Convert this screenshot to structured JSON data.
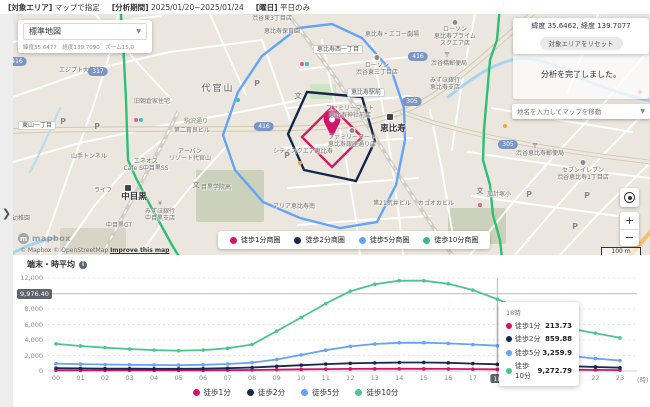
{
  "top_bar": {
    "filters": [
      {
        "label": "[対象エリア]",
        "value": "マップで指定"
      },
      {
        "label": "[分析期間]",
        "value": "2025/01/20~2025/01/24"
      },
      {
        "label": "[曜日]",
        "value": "平日のみ"
      }
    ]
  },
  "sidebar": {
    "expand_chevron": "❯"
  },
  "map": {
    "style_selector": {
      "value": "標準地図",
      "chevron": "▼",
      "meta": "緯度35.6477　経度139.7090　ズーム15.0"
    },
    "coords_panel": {
      "coords": "緯度 35.6462, 経度 139.7077",
      "reset_button": "対象エリアをリセット"
    },
    "toast": "分析を完了しました。",
    "search": {
      "placeholder": "地名を入力してマップを移動",
      "chevron": "▼"
    },
    "legend": [
      {
        "label": "徒歩1分商圏",
        "color": "#d4136b"
      },
      {
        "label": "徒歩2分商圏",
        "color": "#17294d"
      },
      {
        "label": "徒歩5分商圏",
        "color": "#64a3f5"
      },
      {
        "label": "徒歩10分商圏",
        "color": "#3dbd7d"
      }
    ],
    "controls": {
      "zoom_in": "+",
      "zoom_out": "−"
    },
    "scale_label": "100 m",
    "attribution": {
      "logo_text": "mapbox",
      "text": "© Mapbox © OpenStreetMap ",
      "improve_link": "Improve this map"
    },
    "labels": [
      {
        "t": "渋谷代官山郵便局",
        "x": 46,
        "y": 44,
        "c": "poi"
      },
      {
        "t": "エジプト大使館",
        "x": 80,
        "y": 67,
        "c": "poi"
      },
      {
        "t": "代官山",
        "x": 218,
        "y": 84,
        "c": "town"
      },
      {
        "t": "旧朝倉家住宅",
        "x": 152,
        "y": 98,
        "c": "poi"
      },
      {
        "t": "第二育良ビル",
        "x": 192,
        "y": 127,
        "c": "poi"
      },
      {
        "t": "山手トンネル",
        "x": 89,
        "y": 153,
        "c": "poi"
      },
      {
        "t": "アーバン\nリゾート代官山",
        "x": 190,
        "y": 148,
        "c": "poi"
      },
      {
        "t": "エネオス\nCafe S中目黒SS",
        "x": 146,
        "y": 158,
        "c": "poi"
      },
      {
        "t": "ライフ",
        "x": 103,
        "y": 187,
        "c": "poi"
      },
      {
        "t": "中目黒",
        "x": 134,
        "y": 192,
        "c": "station"
      },
      {
        "t": "中目黒GT",
        "x": 119,
        "y": 222,
        "c": "poi"
      },
      {
        "t": "みずほ銀行\n中目黒支店",
        "x": 160,
        "y": 208,
        "c": "poi"
      },
      {
        "t": "目黒学院高",
        "x": 216,
        "y": 184,
        "c": "poi"
      },
      {
        "t": "園幼稚園",
        "x": 18,
        "y": 215,
        "c": "poi"
      },
      {
        "t": "渋谷東3丁目店",
        "x": 272,
        "y": 15,
        "c": "poi"
      },
      {
        "t": "恵比寿保育園",
        "x": 282,
        "y": 28,
        "c": "poi"
      },
      {
        "t": "恵比寿・エコー劇場",
        "x": 392,
        "y": 31,
        "c": "poi"
      },
      {
        "t": "ローソン\n恵比寿プライム\nスクエア店",
        "x": 455,
        "y": 26,
        "c": "poi"
      },
      {
        "t": "ローソン\n渋谷東三丁目店",
        "x": 377,
        "y": 62,
        "c": "poi"
      },
      {
        "t": "ローソン",
        "x": 547,
        "y": 26,
        "c": "poi"
      },
      {
        "t": "渋谷橋郵便局",
        "x": 449,
        "y": 60,
        "c": "poi"
      },
      {
        "t": "みずほ銀行\n恵比寿支店",
        "x": 445,
        "y": 77,
        "c": "poi"
      },
      {
        "t": "ファミリーマート\n恵比寿神社前店",
        "x": 350,
        "y": 105,
        "c": "poi"
      },
      {
        "t": "ファミリーマート\n恵比寿銀座通り店",
        "x": 352,
        "y": 134,
        "c": "poi"
      },
      {
        "t": "恵比寿",
        "x": 393,
        "y": 124,
        "c": "station"
      },
      {
        "t": "シティスクエア恵比寿",
        "x": 303,
        "y": 148,
        "c": "poi"
      },
      {
        "t": "渋谷恵比寿郵便局",
        "x": 540,
        "y": 150,
        "c": "poi"
      },
      {
        "t": "セブンイレブン\n渋谷恵比寿1丁目店",
        "x": 583,
        "y": 167,
        "c": "poi"
      },
      {
        "t": "加計塚小",
        "x": 499,
        "y": 191,
        "c": "poi"
      },
      {
        "t": "カゴオカビル",
        "x": 436,
        "y": 200,
        "c": "poi"
      },
      {
        "t": "第21荒井ビル",
        "x": 392,
        "y": 200,
        "c": "poi"
      },
      {
        "t": "アリア恵比寿南",
        "x": 294,
        "y": 203,
        "c": "poi"
      },
      {
        "t": "駒沢通り",
        "x": 196,
        "y": 118,
        "c": "roadname"
      },
      {
        "t": "東山一丁目",
        "x": 37,
        "y": 121,
        "c": "pill"
      },
      {
        "t": "恵比寿西一丁目",
        "x": 338,
        "y": 45,
        "c": "pill"
      },
      {
        "t": "恵比寿駅前",
        "x": 366,
        "y": 88,
        "c": "pill"
      },
      {
        "t": "317",
        "x": 98,
        "y": 67,
        "c": "route"
      },
      {
        "t": "416",
        "x": 17,
        "y": 57,
        "c": "route"
      },
      {
        "t": "416",
        "x": 264,
        "y": 122,
        "c": "route"
      },
      {
        "t": "416",
        "x": 418,
        "y": 52,
        "c": "route"
      },
      {
        "t": "305",
        "x": 412,
        "y": 97,
        "c": "route"
      },
      {
        "t": "305",
        "x": 508,
        "y": 140,
        "c": "route"
      },
      {
        "t": "P",
        "x": 63,
        "y": 117,
        "c": "picon"
      },
      {
        "t": "P",
        "x": 97,
        "y": 122,
        "c": "picon"
      },
      {
        "t": "P",
        "x": 257,
        "y": 79,
        "c": "picon"
      },
      {
        "t": "P",
        "x": 287,
        "y": 151,
        "c": "picon"
      },
      {
        "t": "P",
        "x": 529,
        "y": 190,
        "c": "picon"
      },
      {
        "t": "P",
        "x": 587,
        "y": 191,
        "c": "picon"
      },
      {
        "t": "P",
        "x": 575,
        "y": 222,
        "c": "picon"
      },
      {
        "t": "文",
        "x": 298,
        "y": 92,
        "c": "school"
      },
      {
        "t": "文",
        "x": 196,
        "y": 181,
        "c": "school"
      },
      {
        "t": "文",
        "x": 480,
        "y": 187,
        "c": "school"
      },
      {
        "t": "文",
        "x": 10,
        "y": 208,
        "c": "school"
      },
      {
        "t": "〒",
        "x": 447,
        "y": 51,
        "c": "post"
      },
      {
        "t": "〒",
        "x": 535,
        "y": 142,
        "c": "post"
      },
      {
        "t": "〒",
        "x": 46,
        "y": 36,
        "c": "post"
      },
      {
        "t": "¥",
        "x": 160,
        "y": 200,
        "c": "yen"
      },
      {
        "t": "",
        "x": 390,
        "y": 113,
        "c": "sticon"
      },
      {
        "t": "",
        "x": 128,
        "y": 184,
        "c": "sticon"
      },
      {
        "t": "",
        "x": 377,
        "y": 54,
        "c": "cicon"
      },
      {
        "t": "",
        "x": 547,
        "y": 19,
        "c": "cicon"
      },
      {
        "t": "",
        "x": 583,
        "y": 159,
        "c": "cicon"
      },
      {
        "t": "",
        "x": 352,
        "y": 127,
        "c": "cicon"
      },
      {
        "t": "",
        "x": 455,
        "y": 19,
        "c": "cicon"
      }
    ],
    "dots": [
      {
        "x": 136,
        "y": 118,
        "color": "#e05c8a"
      },
      {
        "x": 141,
        "y": 118,
        "color": "#3bbccb"
      },
      {
        "x": 302,
        "y": 62,
        "color": "#e05c8a"
      },
      {
        "x": 307,
        "y": 62,
        "color": "#3bbccb"
      },
      {
        "x": 505,
        "y": 124,
        "color": "#f0a33c"
      },
      {
        "x": 576,
        "y": 108,
        "color": "#3bbccb"
      },
      {
        "x": 640,
        "y": 90,
        "color": "#e05c8a"
      },
      {
        "x": 480,
        "y": 203,
        "color": "#e05c8a"
      },
      {
        "x": 238,
        "y": 98,
        "color": "#3bbccb"
      },
      {
        "x": 300,
        "y": 161,
        "color": "#f0a33c"
      }
    ]
  },
  "chart": {
    "title": "端末・時平均",
    "info_icon": "i",
    "max_badge": "9,976.40",
    "unit_suffix": "(時)",
    "y_ticks": [
      {
        "v": 12000,
        "t": "12,000"
      },
      {
        "v": 8000,
        "t": "8,000"
      },
      {
        "v": 6000,
        "t": "6,000"
      },
      {
        "v": 4000,
        "t": "4,000"
      },
      {
        "v": 2000,
        "t": "2,000"
      },
      {
        "v": 0,
        "t": "0"
      }
    ],
    "selected_hour": "18",
    "tooltip": {
      "header": "18時",
      "rows": [
        {
          "label": "徒歩1分",
          "value": "213.73",
          "color": "#d4136b"
        },
        {
          "label": "徒歩2分",
          "value": "859.88",
          "color": "#17294d"
        },
        {
          "label": "徒歩5分",
          "value": "3,259.9",
          "color": "#64a3f5"
        },
        {
          "label": "徒歩10分",
          "value": "9,272.79",
          "color": "#4cc68e"
        }
      ]
    }
  },
  "chart_data": {
    "type": "line",
    "title": "端末・時平均",
    "x": [
      "00",
      "01",
      "02",
      "03",
      "04",
      "05",
      "06",
      "07",
      "08",
      "09",
      "10",
      "11",
      "12",
      "13",
      "14",
      "15",
      "16",
      "17",
      "18",
      "19",
      "20",
      "21",
      "22",
      "23"
    ],
    "xlabel": "(時)",
    "ylabel": "",
    "ylim": [
      0,
      12000
    ],
    "grid": true,
    "legend_position": "bottom",
    "reference_line": 9976.4,
    "selected_x": "18",
    "series": [
      {
        "name": "徒歩1分",
        "color": "#d4136b",
        "values": [
          95,
          88,
          84,
          80,
          78,
          78,
          85,
          105,
          135,
          175,
          215,
          245,
          265,
          278,
          283,
          280,
          268,
          240,
          213.73,
          195,
          178,
          162,
          140,
          118
        ]
      },
      {
        "name": "徒歩2分",
        "color": "#17294d",
        "values": [
          360,
          330,
          310,
          295,
          285,
          285,
          305,
          355,
          450,
          600,
          750,
          890,
          990,
          1050,
          1095,
          1100,
          1055,
          960,
          859.88,
          760,
          680,
          620,
          520,
          420
        ]
      },
      {
        "name": "徒歩5分",
        "color": "#64a3f5",
        "values": [
          950,
          890,
          840,
          800,
          775,
          760,
          800,
          900,
          1090,
          1480,
          2080,
          2680,
          3180,
          3480,
          3640,
          3650,
          3560,
          3420,
          3259.9,
          2880,
          2560,
          1950,
          1600,
          1350
        ]
      },
      {
        "name": "徒歩10分",
        "color": "#4cc68e",
        "values": [
          3500,
          3230,
          3010,
          2840,
          2700,
          2620,
          2700,
          2930,
          3420,
          5150,
          6900,
          8700,
          10300,
          11200,
          11650,
          11650,
          11250,
          10450,
          9272.79,
          7900,
          6600,
          5450,
          4880,
          4280
        ]
      }
    ]
  }
}
